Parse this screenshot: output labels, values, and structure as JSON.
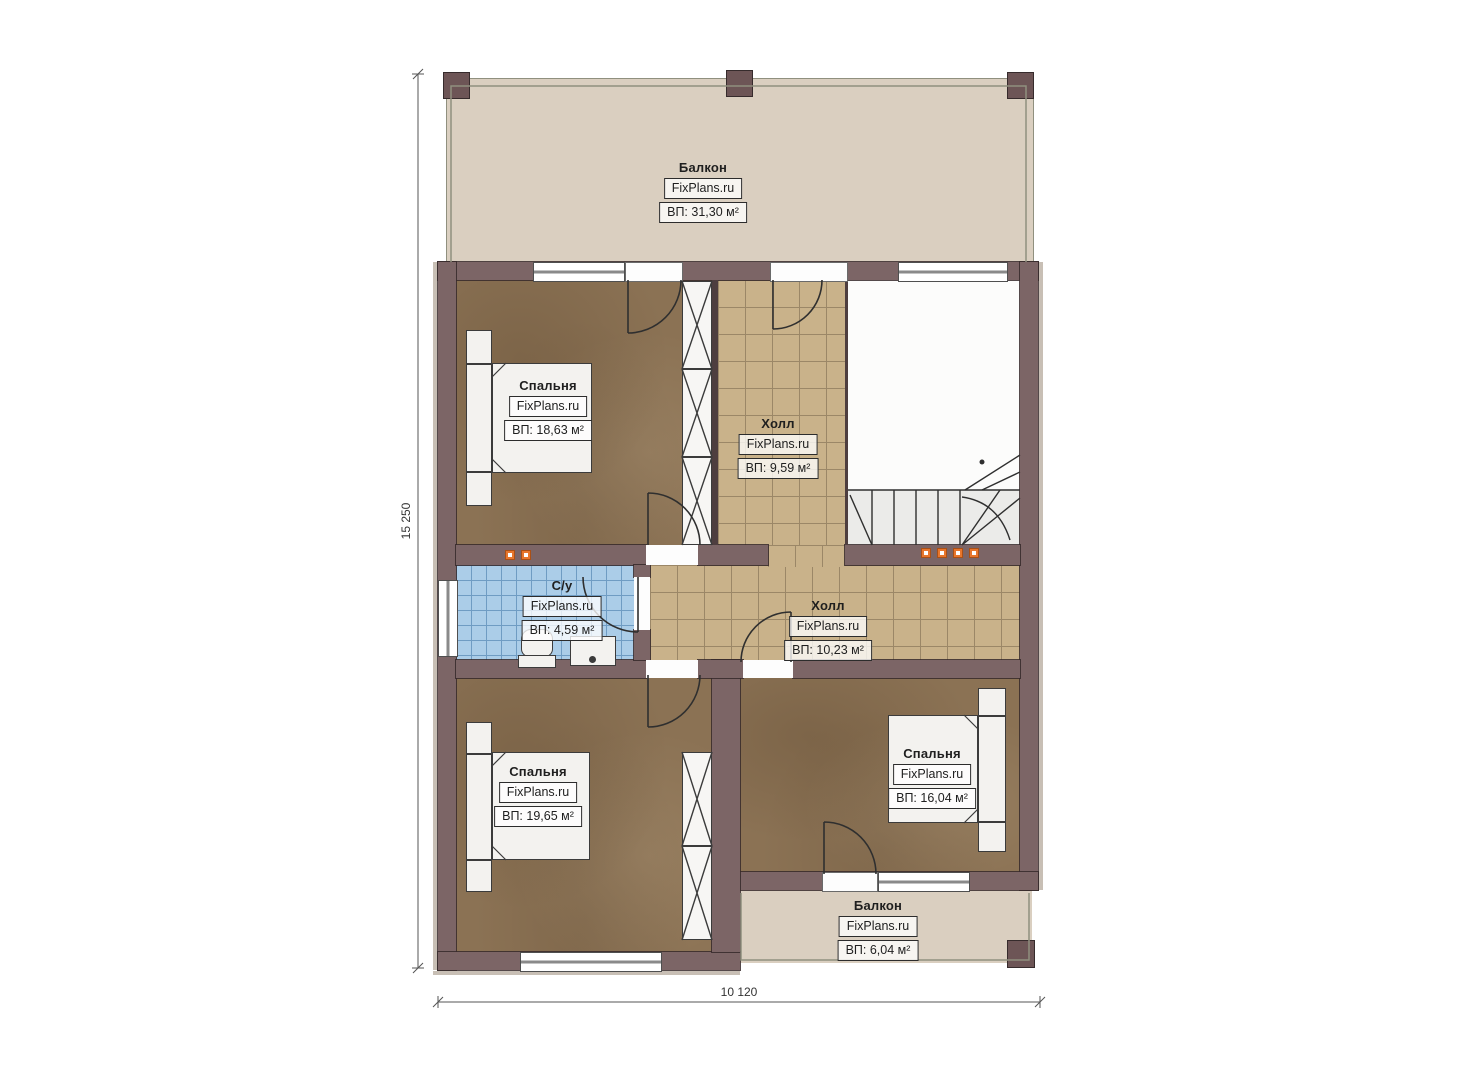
{
  "plan_title": "floor-plan-second-level",
  "rooms": [
    {
      "id": "balcony-top",
      "name": "Балкон",
      "brand": "FixPlans.ru",
      "area": "ВП: 31,30 м²"
    },
    {
      "id": "bedroom-1",
      "name": "Спальня",
      "brand": "FixPlans.ru",
      "area": "ВП: 18,63 м²"
    },
    {
      "id": "hall-upper",
      "name": "Холл",
      "brand": "FixPlans.ru",
      "area": "ВП: 9,59 м²"
    },
    {
      "id": "bathroom",
      "name": "С/у",
      "brand": "FixPlans.ru",
      "area": "ВП: 4,59 м²"
    },
    {
      "id": "hall-lower",
      "name": "Холл",
      "brand": "FixPlans.ru",
      "area": "ВП: 10,23 м²"
    },
    {
      "id": "bedroom-2",
      "name": "Спальня",
      "brand": "FixPlans.ru",
      "area": "ВП: 19,65 м²"
    },
    {
      "id": "bedroom-3",
      "name": "Спальня",
      "brand": "FixPlans.ru",
      "area": "ВП: 16,04 м²"
    },
    {
      "id": "balcony-bottom",
      "name": "Балкон",
      "brand": "FixPlans.ru",
      "area": "ВП: 6,04 м²"
    }
  ],
  "dimensions": {
    "vertical": "15 250",
    "horizontal": "10 120"
  },
  "colors": {
    "wall": "#7c6566",
    "bedroom_floor": "#8b7254",
    "hall_tile": "#c9b28a",
    "bath_tile": "#abcde8",
    "balcony_floor": "#dacfc0",
    "marker_orange": "#e8762c"
  }
}
